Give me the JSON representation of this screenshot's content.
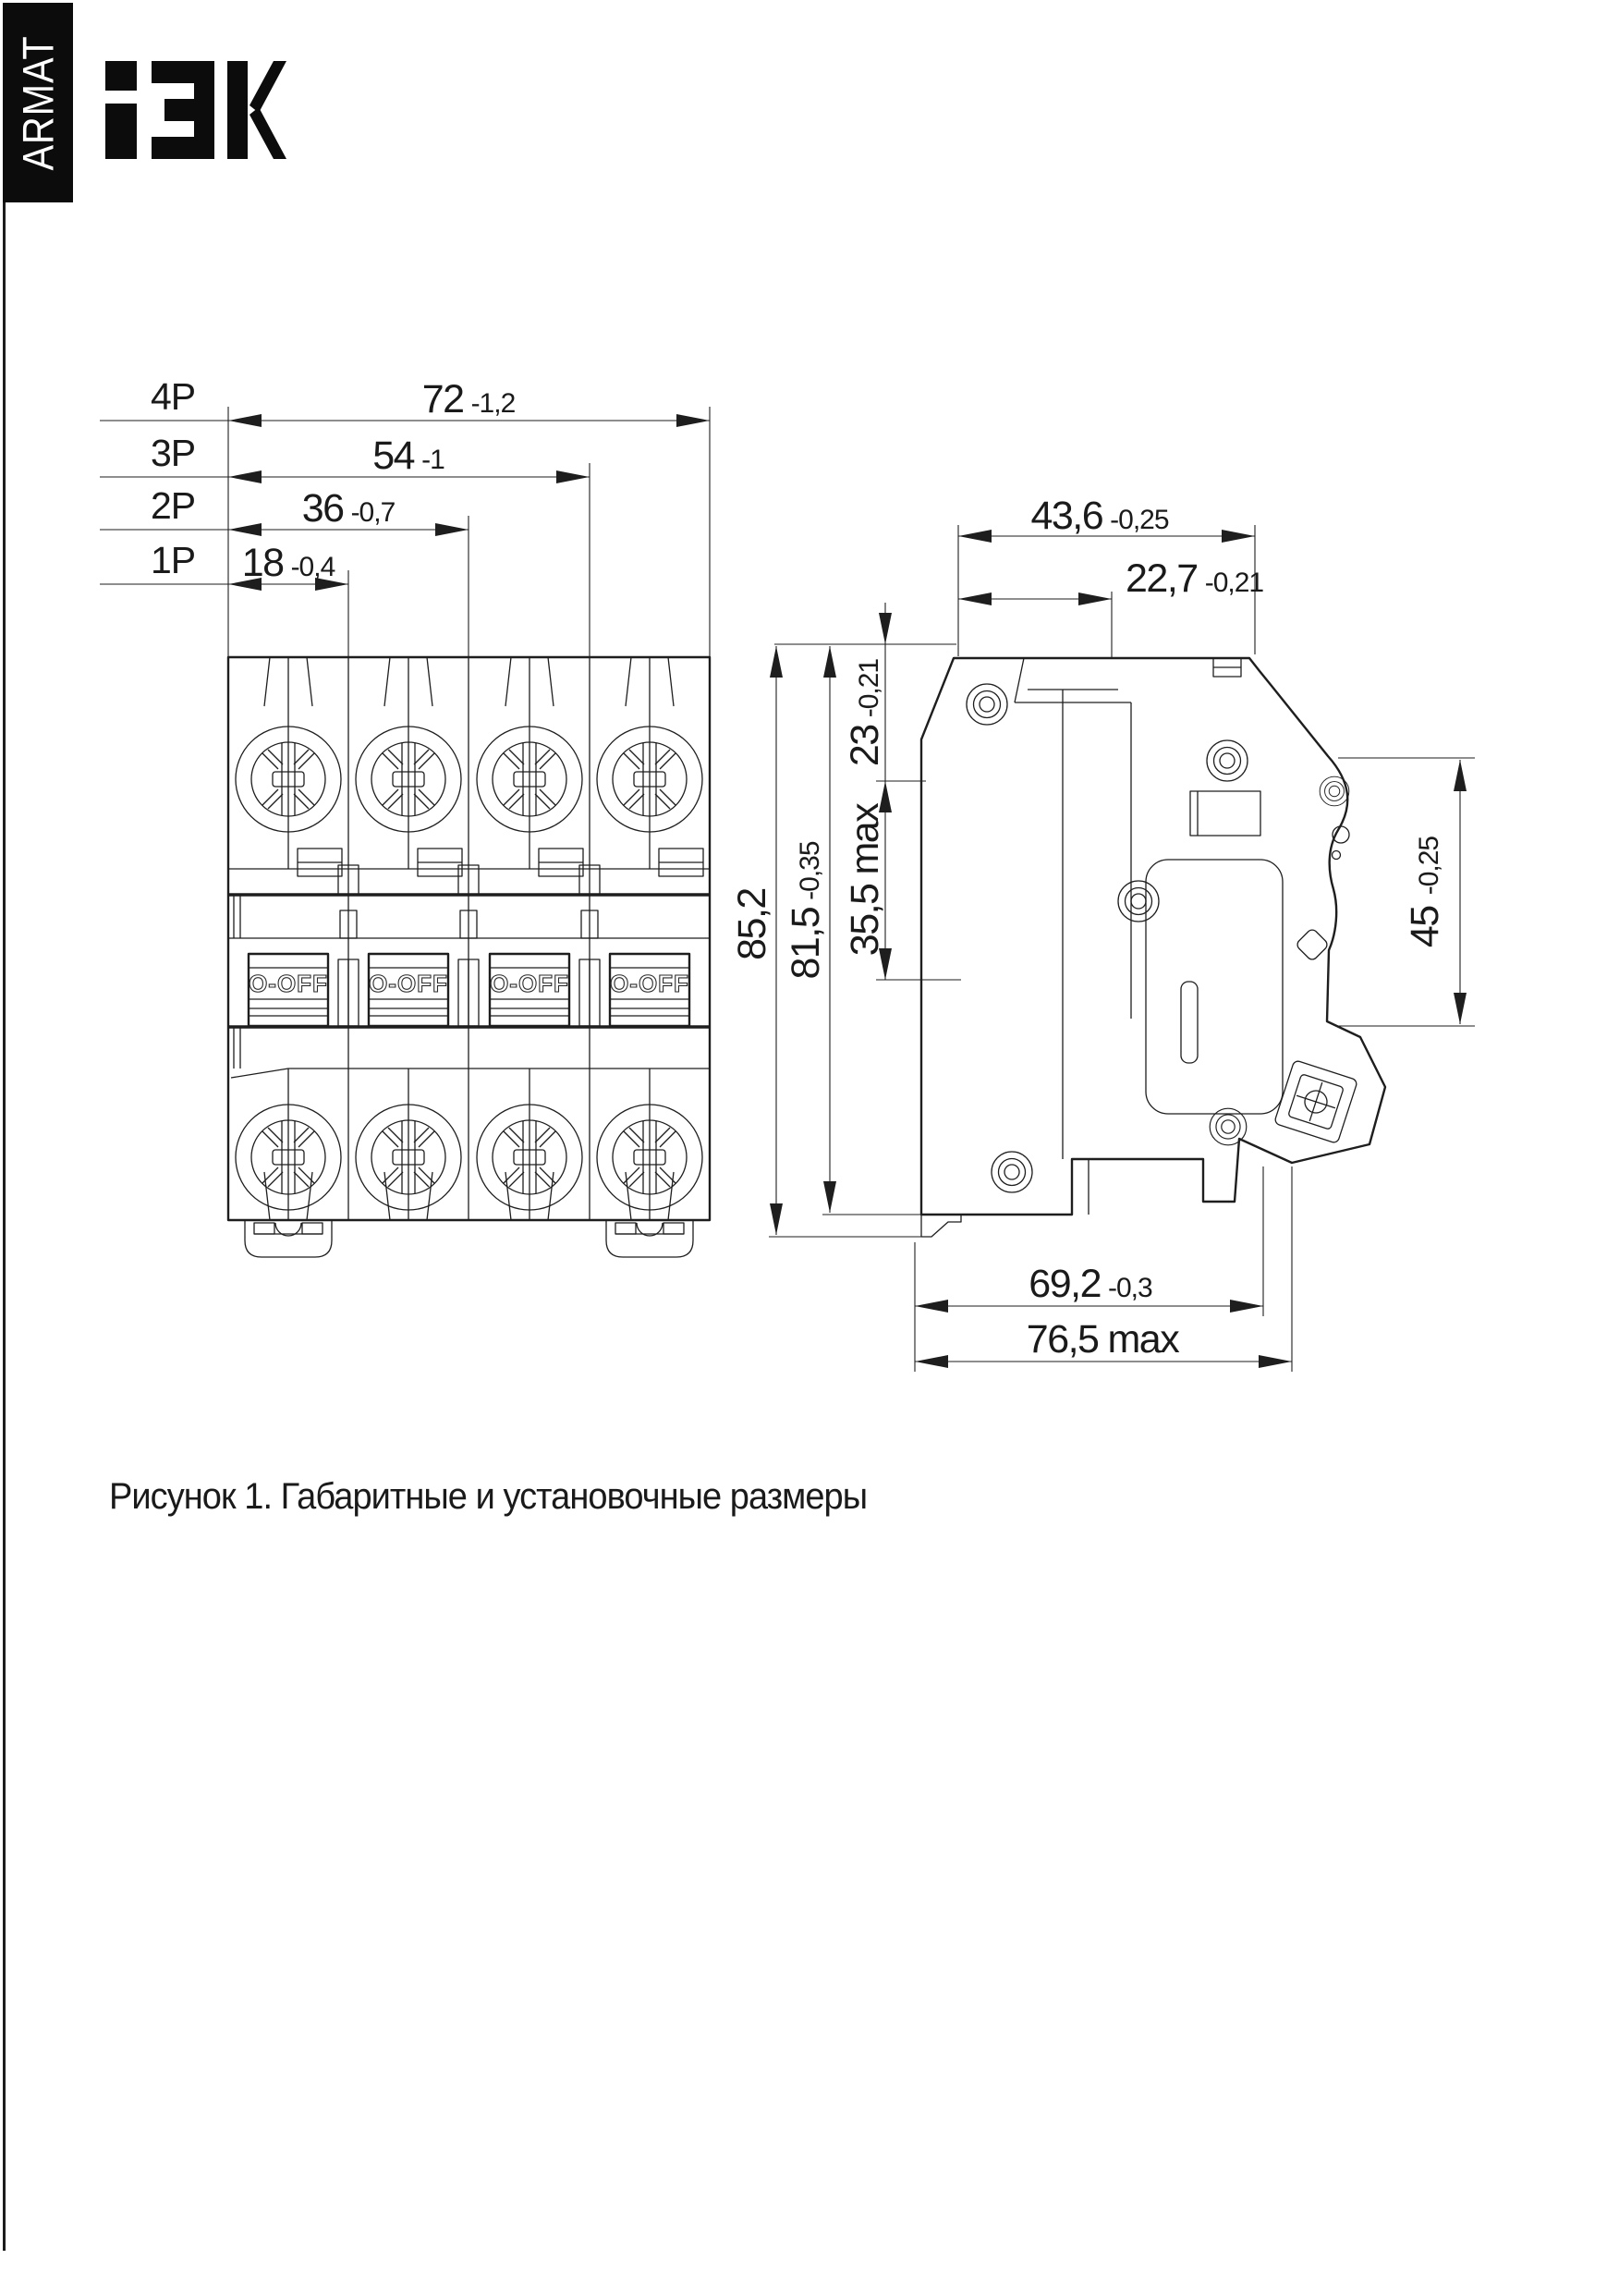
{
  "brand": {
    "armat_label": "ARMAT",
    "logo_alt": "IEK",
    "bar_color": "#0c0c0c"
  },
  "front_view": {
    "pole_dims": [
      {
        "pole": "4P",
        "nominal": "72",
        "tolerance": "-1,2"
      },
      {
        "pole": "3P",
        "nominal": "54",
        "tolerance": "-1"
      },
      {
        "pole": "2P",
        "nominal": "36",
        "tolerance": "-0,7"
      },
      {
        "pole": "1P",
        "nominal": "18",
        "tolerance": "-0,4"
      }
    ],
    "toggle_label": "O-OFF"
  },
  "side_view": {
    "dims": {
      "depth_top": {
        "nominal": "43,6",
        "tolerance": "-0,25"
      },
      "handle_offset": {
        "nominal": "22,7",
        "tolerance": "-0,21"
      },
      "top_to_boss": {
        "nominal": "23",
        "tolerance": "-0,21"
      },
      "boss_zone": {
        "nominal": "35,5",
        "suffix": "max"
      },
      "height_overall": {
        "nominal": "85,2"
      },
      "height_body": {
        "nominal": "81,5",
        "tolerance": "-0,35"
      },
      "front_face": {
        "nominal": "45",
        "tolerance": "-0,25"
      },
      "depth_body": {
        "nominal": "69,2",
        "tolerance": "-0,3"
      },
      "depth_overall": {
        "nominal": "76,5",
        "suffix": "max"
      }
    }
  },
  "caption": "Рисунок 1. Габаритные и установочные размеры",
  "colors": {
    "line": "#1e1e1e",
    "background": "#ffffff"
  }
}
